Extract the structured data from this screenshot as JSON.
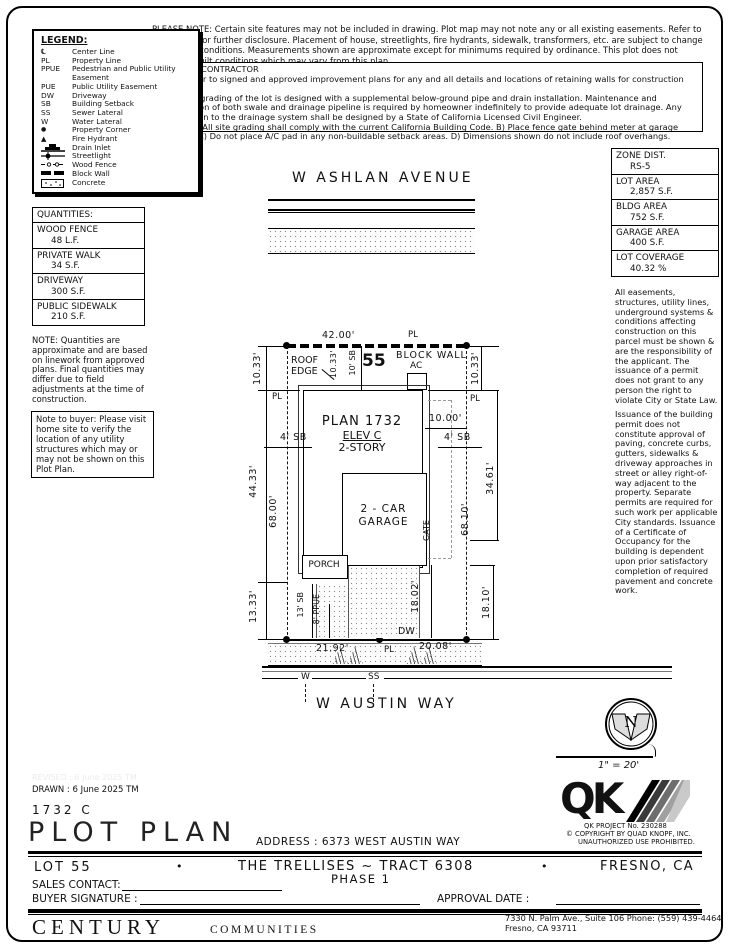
{
  "meta": {
    "ink": "#000000",
    "paper": "#ffffff"
  },
  "notices": {
    "please_note": "PLEASE NOTE:  Certain site features may not be included in drawing.  Plot map may not note any or all existing easements.  Refer to title report for further disclosure.  Placement of house, streetlights, fire hydrants, sidewalk, transformers, etc. are subject to change due to site conditions.  Measurements shown are approximate except for minimums required by ordinance.  This plot does not reflect as-built conditions which may vary from this plan.",
    "contractor": {
      "title": "*NOTE TO CONTRACTOR",
      "p1": "Please refer to signed and approved improvement plans for any and all details and locations of retaining walls for construction purposes.",
      "p2": "The finish grading of the lot is designed with a supplemental below-ground pipe and drain installation.  Maintenance and preservation of both swale and drainage pipeline is required by homeowner indefinitely to provide adequate lot drainage.  Any modification to the drainage system shall be designed by a State of California Licensed Civil Engineer.",
      "p3": "NOTES:  A) All site grading shall comply with the current California Building Code.  B) Place fence gate behind meter at garage side, typ.  C) Do not place A/C pad in any non-buildable setback areas.  D) Dimensions shown do not include roof overhangs."
    }
  },
  "legend": {
    "title": "LEGEND:",
    "items": [
      {
        "sym": "℄",
        "label": "Center Line"
      },
      {
        "sym": "PL",
        "label": "Property Line"
      },
      {
        "sym": "PPUE",
        "label": "Pedestrian and Public Utility Easement"
      },
      {
        "sym": "PUE",
        "label": "Public Utility Easement"
      },
      {
        "sym": "DW",
        "label": "Driveway"
      },
      {
        "sym": "SB",
        "label": "Building Setback"
      },
      {
        "sym": "SS",
        "label": "Sewer Lateral"
      },
      {
        "sym": "W",
        "label": "Water Lateral"
      },
      {
        "sym": "●",
        "label": "Property Corner"
      },
      {
        "sym": "▲",
        "label": "Fire Hydrant"
      },
      {
        "icon": "drain-inlet-icon",
        "label": "Drain Inlet"
      },
      {
        "icon": "streetlight-icon",
        "label": "Streetlight"
      },
      {
        "icon": "wood-fence-icon",
        "label": "Wood Fence"
      },
      {
        "icon": "block-wall-icon",
        "label": "Block Wall"
      },
      {
        "icon": "concrete-icon",
        "label": "Concrete"
      }
    ]
  },
  "quantities": {
    "title": "QUANTITIES:",
    "items": [
      {
        "name": "WOOD FENCE",
        "value": "48 L.F."
      },
      {
        "name": "PRIVATE WALK",
        "value": "34 S.F."
      },
      {
        "name": "DRIVEWAY",
        "value": "300 S.F."
      },
      {
        "name": "PUBLIC SIDEWALK",
        "value": "210 S.F."
      }
    ],
    "note": "NOTE: Quantities are approximate and are based on linework from approved plans.  Final quantities may differ due to field adjustments at the time of construction.",
    "buyer_note": "Note to buyer: Please visit home site to verify the location of any utility structures which may or may not be shown on this Plot Plan."
  },
  "zoning": {
    "items": [
      {
        "label": "ZONE DIST.",
        "value": "RS-5"
      },
      {
        "label": "LOT AREA",
        "value": "2,857 S.F."
      },
      {
        "label": "BLDG AREA",
        "value": "752 S.F."
      },
      {
        "label": "GARAGE AREA",
        "value": "400 S.F."
      },
      {
        "label": "LOT COVERAGE",
        "value": "40.32 %"
      }
    ],
    "note1": "All easements, structures, utility lines, underground systems & conditions affecting construction on this parcel must be shown & are the responsibility of the applicant. The issuance of a permit does not grant to any person the right to violate City or State Law.",
    "note2": "Issuance of the building permit does not constitute approval of paving, concrete curbs, gutters, sidewalks & driveway approaches in street or alley right-of-way adjacent to the property. Separate permits are required for such work per applicable City standards. Issuance of a Certificate of Occupancy for the building is dependent upon prior satisfactory completion of required pavement and concrete work."
  },
  "plot": {
    "street_top": "W ASHLAN AVENUE",
    "street_bottom": "W AUSTIN WAY",
    "lot_number": "55",
    "block_wall": "BLOCK WALL",
    "roof_edge": "ROOF EDGE",
    "ac": "AC",
    "plan": "PLAN 1732",
    "elev": "ELEV C",
    "story": "2-STORY",
    "garage_line1": "2 - CAR",
    "garage_line2": "GARAGE",
    "gate": "GATE",
    "porch": "PORCH",
    "dw": "DW",
    "pl": "PL",
    "water": "W",
    "sewer": "SS",
    "dims": {
      "top": "42.00'",
      "left_top": "10.33'",
      "right_top": "10.33'",
      "inner_roof": "10.33'",
      "roof_sb": "10' SB",
      "left_mid": "44.33'",
      "left_depth": "68.00'",
      "right_depth": "68.10'",
      "right_mid": "34.61'",
      "left_bottom": "13.33'",
      "right_bottom": "18.10'",
      "drive_depth": "18.02'",
      "sb_left": "4' SB",
      "sb_right": "4' SB",
      "offset_right": "10.00'",
      "sb_front": "13' SB",
      "ppue": "8' PPUE",
      "frontage_left": "21.92'",
      "frontage_right": "20.08'"
    }
  },
  "north": {
    "letter": "N",
    "scale": "1\" = 20'"
  },
  "titleblock": {
    "revised": "REVISED :  6 June 2025  TM",
    "drawn": "DRAWN :  6 June 2025  TM",
    "plan_code": "1732  C",
    "title": "PLOT PLAN",
    "address": "ADDRESS :  6373 WEST AUSTIN WAY",
    "lot": "LOT 55",
    "bullet": "•",
    "tract": "THE TRELLISES ~ TRACT 6308",
    "phase": "PHASE 1",
    "city": "FRESNO, CA",
    "sales_contact": "SALES CONTACT:",
    "buyer_signature": "BUYER SIGNATURE :",
    "approval_date": "APPROVAL DATE :",
    "qk_project": "QK PROJECT No. 230288",
    "copyright": "©  COPYRIGHT BY QUAD KNOPF, INC.",
    "unauthorized": "UNAUTHORIZED USE PROHIBITED.",
    "qk_letters": "QK",
    "brand_century": "CENTURY",
    "brand_communities": "COMMUNITIES",
    "office_line1": "7330 N. Palm Ave., Suite 106    Phone:  (559) 439-4464",
    "office_line2": "Fresno, CA  93711"
  }
}
